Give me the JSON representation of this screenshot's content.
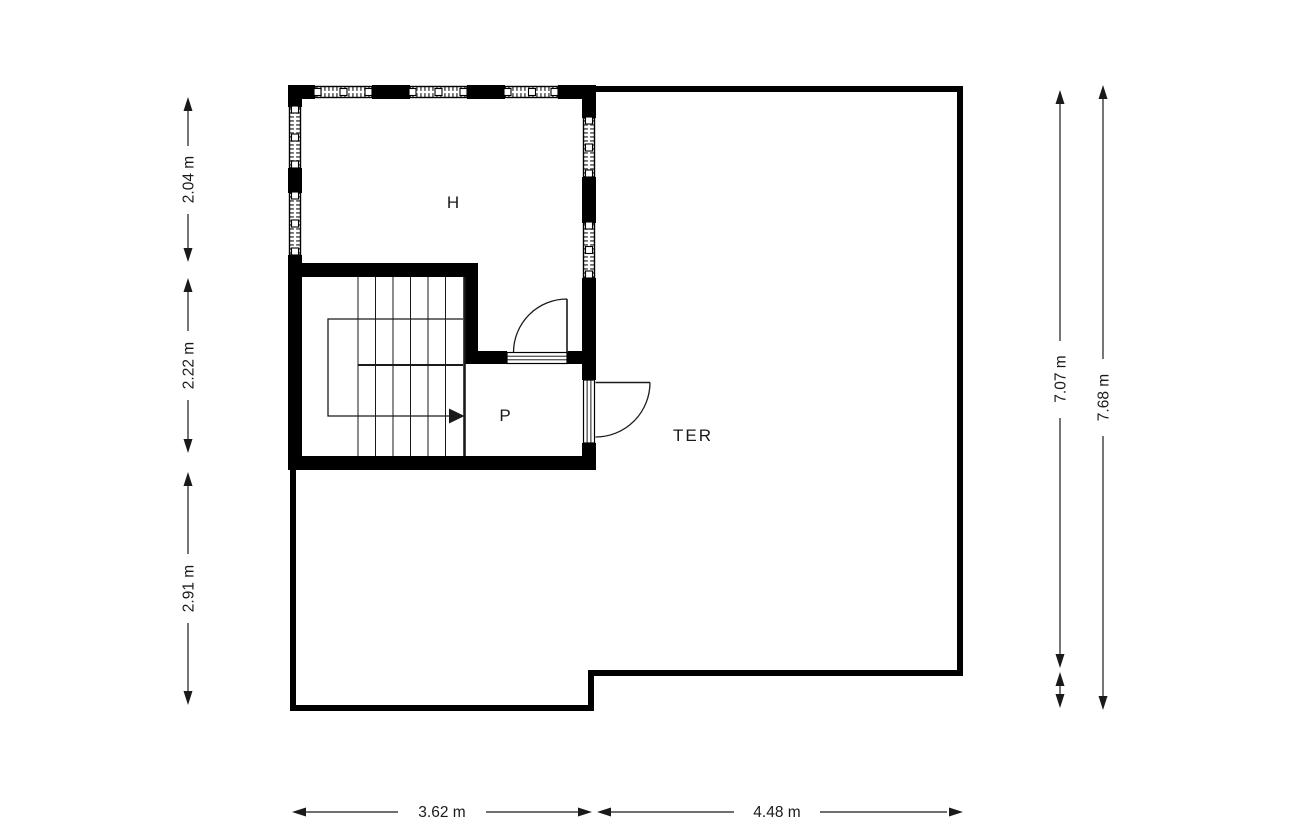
{
  "rooms": {
    "h": {
      "label": "H"
    },
    "p": {
      "label": "P"
    },
    "ter": {
      "label": "TER"
    }
  },
  "dimensions": {
    "left_top": "2.04 m",
    "left_middle": "2.22 m",
    "left_bottom": "2.91 m",
    "right_inner": "7.07 m",
    "right_outer": "7.68 m",
    "bottom_left": "3.62 m",
    "bottom_right": "4.48 m"
  },
  "colors": {
    "wall": "#000000",
    "background": "#ffffff",
    "window_hatch": "#6e6e6e",
    "dimension": "#1a1a1a"
  }
}
